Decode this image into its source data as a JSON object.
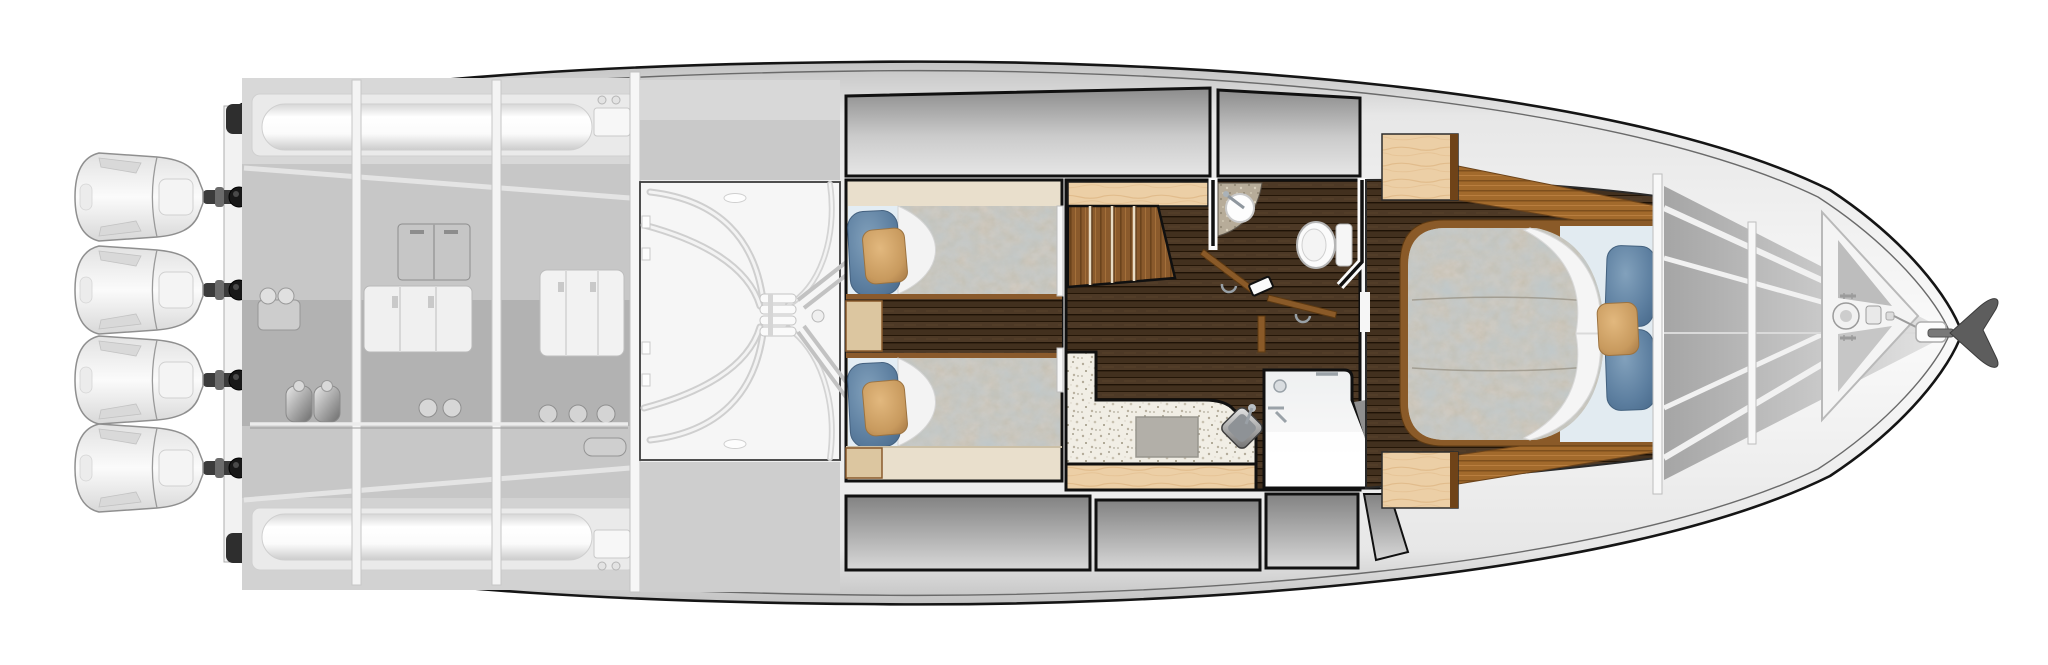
{
  "meta": {
    "description": "Top-down lower-deck floorplan of a yacht, bow facing right, quad outboard engines at stern",
    "orientation": "bow-right",
    "background": "#ffffff"
  },
  "counts": {
    "outboard_engines": 4,
    "guest_twin_berths": 2,
    "master_berths": 1,
    "toilets": 1,
    "sinks": 3,
    "showers": 1,
    "stair_treads": 4,
    "bow_bulkheads": 2
  },
  "rooms": {
    "engine_room": {
      "label": "engine room"
    },
    "steering_compartment": {
      "label": "steering gear compartment"
    },
    "guest_cabin": {
      "label": "guest cabin with twin berths"
    },
    "staircase": {
      "label": "companionway stairs"
    },
    "head": {
      "label": "head with toilet and sink"
    },
    "galley": {
      "label": "galley counter"
    },
    "shower": {
      "label": "shower stall"
    },
    "master_stateroom": {
      "label": "master stateroom"
    },
    "bow_locker": {
      "label": "anchor locker and bow storage"
    }
  },
  "palette": {
    "hull_outline": "#151515",
    "hull_fill_light": "#fafafa",
    "hull_fill_shade": "#c2c2c2",
    "room_gray_dark": "#8c8c8c",
    "room_gray_light": "#e6e6e6",
    "walnut_floor": "#45321f",
    "teak_trim": "#a26a2c",
    "birch_wood": "#eccfa6",
    "beige_upholstery": "#e9dfcc",
    "sheet_blue": "#e3edf4",
    "pillow_blue": "#5d7fa0",
    "pillow_gold": "#c89a5e",
    "quilt_base": "#c6c0b2",
    "granite_white": "#f1eee5",
    "granite_tan": "#b7ac99",
    "stainless": "#8e9296",
    "anchor_gray": "#5d5d5d"
  }
}
